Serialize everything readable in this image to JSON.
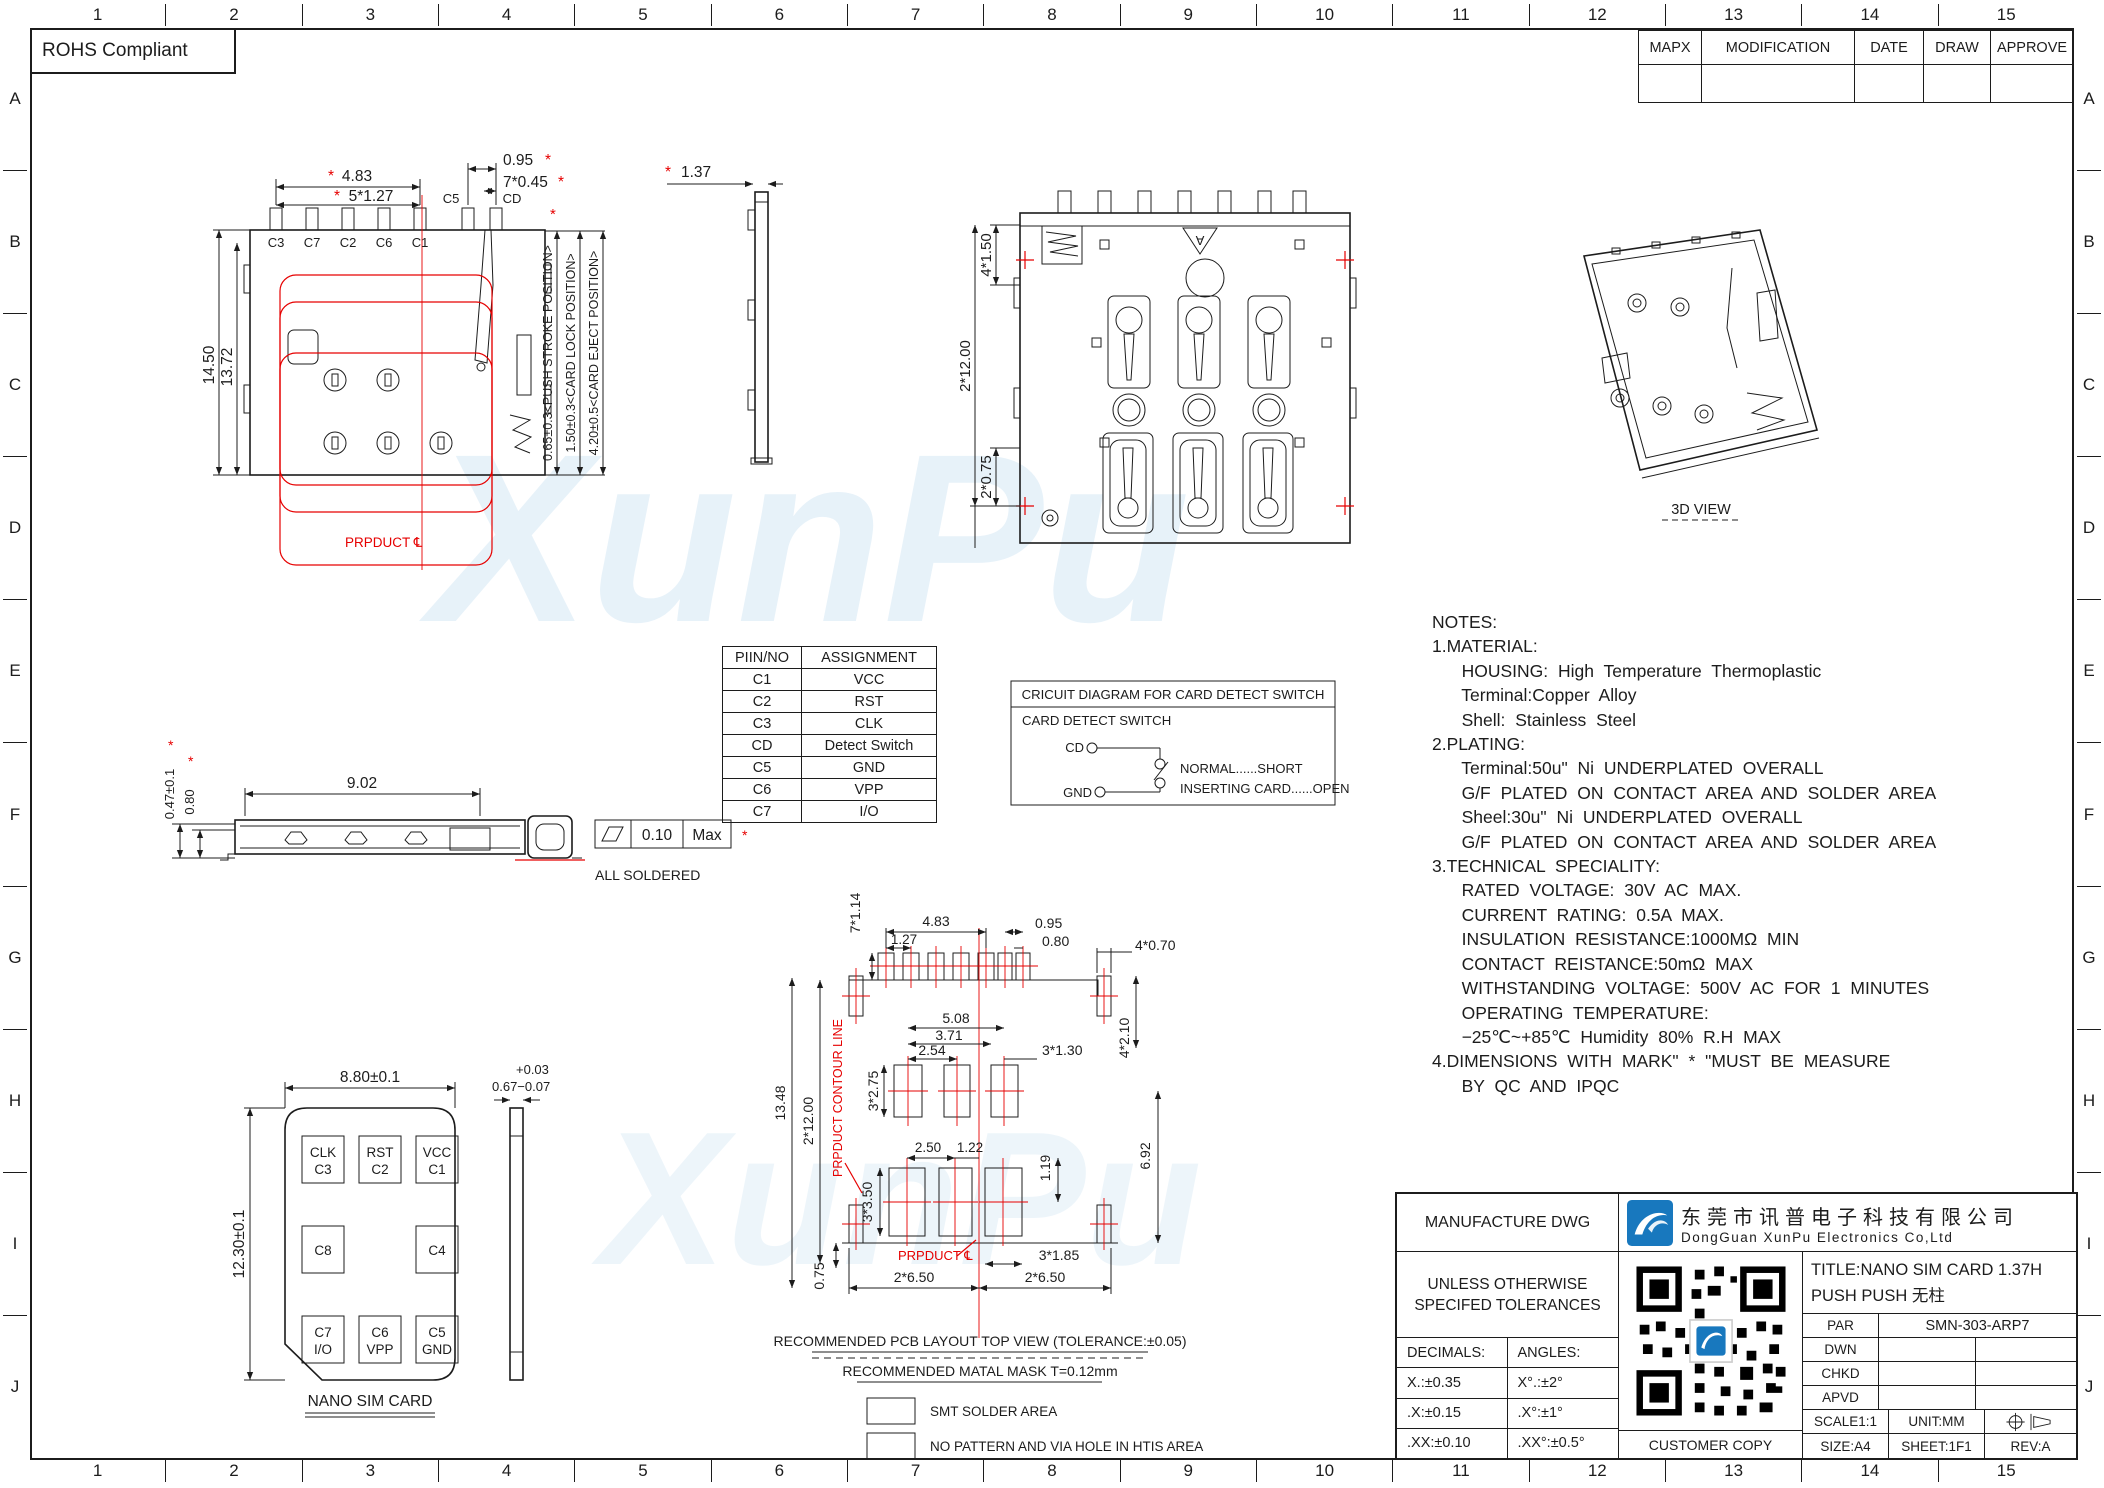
{
  "frame": {
    "cols": [
      "1",
      "2",
      "3",
      "4",
      "5",
      "6",
      "7",
      "8",
      "9",
      "10",
      "11",
      "12",
      "13",
      "14",
      "15"
    ],
    "rows": [
      "A",
      "B",
      "C",
      "D",
      "E",
      "F",
      "G",
      "H",
      "I",
      "J"
    ],
    "rohs": "ROHS Compliant"
  },
  "watermark": "XunPu",
  "marks": {
    "star": "*"
  },
  "rev_table": {
    "headers": [
      "MAPX",
      "MODIFICATION",
      "DATE",
      "DRAW",
      "APPROVE"
    ]
  },
  "top_view": {
    "dim_width": "4.83",
    "dim_pitch": "5*1.27",
    "dim_cd_width": "0.95",
    "dim_pin_width": "7*0.45",
    "dim_height": "14.50",
    "dim_height2": "13.72",
    "pins": [
      "C3",
      "C7",
      "C2",
      "C6",
      "C1"
    ],
    "pin_c5": "C5",
    "pin_cd": "CD",
    "pos_push": "0.65±0.3<PUSH STROKE POSITION>",
    "pos_lock": "1.50±0.3<CARD LOCK POSITION>",
    "pos_eject": "4.20±0.5<CARD EJECT POSITION>",
    "product_cl": "PRPDUCT ℄"
  },
  "side_small": {
    "dim_height": "1.37"
  },
  "bottom_view": {
    "dim_pitch": "4*1.50",
    "dim_height": "2*12.00",
    "dim_edge": "2*0.75",
    "datum": "A"
  },
  "view_3d": {
    "label": "3D VIEW"
  },
  "side_view": {
    "dim_len": "9.02",
    "dim_h1": "0.47±0.1",
    "dim_h2": "0.80",
    "flat_val": "0.10",
    "flat_max": "Max",
    "note": "ALL SOLDERED"
  },
  "pin_table": {
    "headers": [
      "PIIN/NO",
      "ASSIGNMENT"
    ],
    "rows": [
      [
        "C1",
        "VCC"
      ],
      [
        "C2",
        "RST"
      ],
      [
        "C3",
        "CLK"
      ],
      [
        "CD",
        "Detect Switch"
      ],
      [
        "C5",
        "GND"
      ],
      [
        "C6",
        "VPP"
      ],
      [
        "C7",
        "I/O"
      ]
    ]
  },
  "circuit": {
    "title": "CRICUIT DIAGRAM FOR CARD DETECT SWITCH",
    "subtitle": "CARD DETECT SWITCH",
    "cd": "CD",
    "gnd": "GND",
    "normal": "NORMAL......SHORT",
    "inserting": "INSERTING CARD......OPEN"
  },
  "notes": {
    "title": "NOTES:",
    "lines": [
      "1.MATERIAL:",
      "   HOUSING: High Temperature Thermoplastic",
      "   Terminal:Copper Alloy",
      "   Shell: Stainless Steel",
      "2.PLATING:",
      "   Terminal:50u\" Ni UNDERPLATED OVERALL",
      "   G/F PLATED ON CONTACT AREA AND SOLDER AREA",
      "   Sheel:30u\" Ni UNDERPLATED OVERALL",
      "   G/F PLATED ON CONTACT AREA AND SOLDER AREA",
      "3.TECHNICAL SPECIALITY:",
      "   RATED VOLTAGE: 30V AC MAX.",
      "   CURRENT RATING: 0.5A MAX.",
      "   INSULATION RESISTANCE:1000MΩ MIN",
      "   CONTACT REISTANCE:50mΩ MAX",
      "   WITHSTANDING VOLTAGE: 500V AC FOR 1 MINUTES",
      "   OPERATING TEMPERATURE:",
      "   −25℃~+85℃ Humidity 80% R.H MAX",
      "4.DIMENSIONS WITH MARK\" * \"MUST BE MEASURE",
      "   BY QC AND IPQC"
    ]
  },
  "sim_card": {
    "dim_w": "8.80±0.1",
    "dim_h": "12.30±0.1",
    "dim_t_plus": "+0.03",
    "dim_t": "0.67−0.07",
    "pads_top": [
      [
        "CLK",
        "C3"
      ],
      [
        "RST",
        "C2"
      ],
      [
        "VCC",
        "C1"
      ]
    ],
    "pad_c8": "C8",
    "pad_c4": "C4",
    "pads_bottom": [
      [
        "C7",
        "I/O"
      ],
      [
        "C6",
        "VPP"
      ],
      [
        "C5",
        "GND"
      ]
    ],
    "label": "NANO SIM CARD"
  },
  "pcb": {
    "dim_pin_w": "7*1.14",
    "dim_row_w": "4.83",
    "dim_pitch": "1.27",
    "dim_cd1": "0.95",
    "dim_cd2": "0.80",
    "dim_corner_w": "4*0.70",
    "dim_mid_span": "5.08",
    "dim_mid_span2": "3.71",
    "dim_mid_pitch": "2.54",
    "dim_mid_w": "3*1.30",
    "dim_mid_h": "3*2.75",
    "dim_body_h": "2*12.00",
    "dim_total_h": "13.48",
    "dim_corner_h": "4*2.10",
    "dim_low_pitch": "2.50",
    "dim_low_gap": "1.22",
    "dim_low_off": "1.19",
    "dim_right_h": "6.92",
    "dim_low_h": "3*3.50",
    "dim_low_w": "3*1.85",
    "dim_edge": "0.75",
    "dim_half_l": "2*6.50",
    "dim_half_r": "2*6.50",
    "contour": "PRPDUCT CONTOUR LINE",
    "product_cl": "PRPDUCT ℄",
    "caption1": "RECOMMENDED PCB LAYOUT TOP VIEW (TOLERANCE:±0.05)",
    "caption2": "RECOMMENDED MATAL MASK T=0.12mm",
    "legend_smt": "SMT SOLDER AREA",
    "legend_np": "NO PATTERN AND VIA HOLE IN HTIS AREA"
  },
  "title_block": {
    "manufacture": "MANUFACTURE DWG",
    "company_cn": "东莞市讯普电子科技有限公司",
    "company_en": "DongGuan XunPu Electronics Co,Ltd",
    "tol_heading1": "UNLESS OTHERWISE",
    "tol_heading2": "SPECIFED TOLERANCES",
    "decimals": "DECIMALS:",
    "angles": "ANGLES:",
    "tol_rows": [
      [
        "X.:±0.35",
        "X°.:±2°"
      ],
      [
        ".X:±0.15",
        ".X°:±1°"
      ],
      [
        ".XX:±0.10",
        ".XX°:±0.5°"
      ]
    ],
    "customer_copy": "CUSTOMER COPY",
    "title_line1": "TITLE:NANO SIM CARD 1.37H",
    "title_line2": "PUSH PUSH 无柱",
    "par": "PAR",
    "part_no": "SMN-303-ARP7",
    "dwn": "DWN",
    "chkd": "CHKD",
    "apvd": "APVD",
    "scale": "SCALE1:1",
    "unit": "UNIT:MM",
    "size": "SIZE:A4",
    "sheet": "SHEET:1F1",
    "rev": "REV:A"
  }
}
